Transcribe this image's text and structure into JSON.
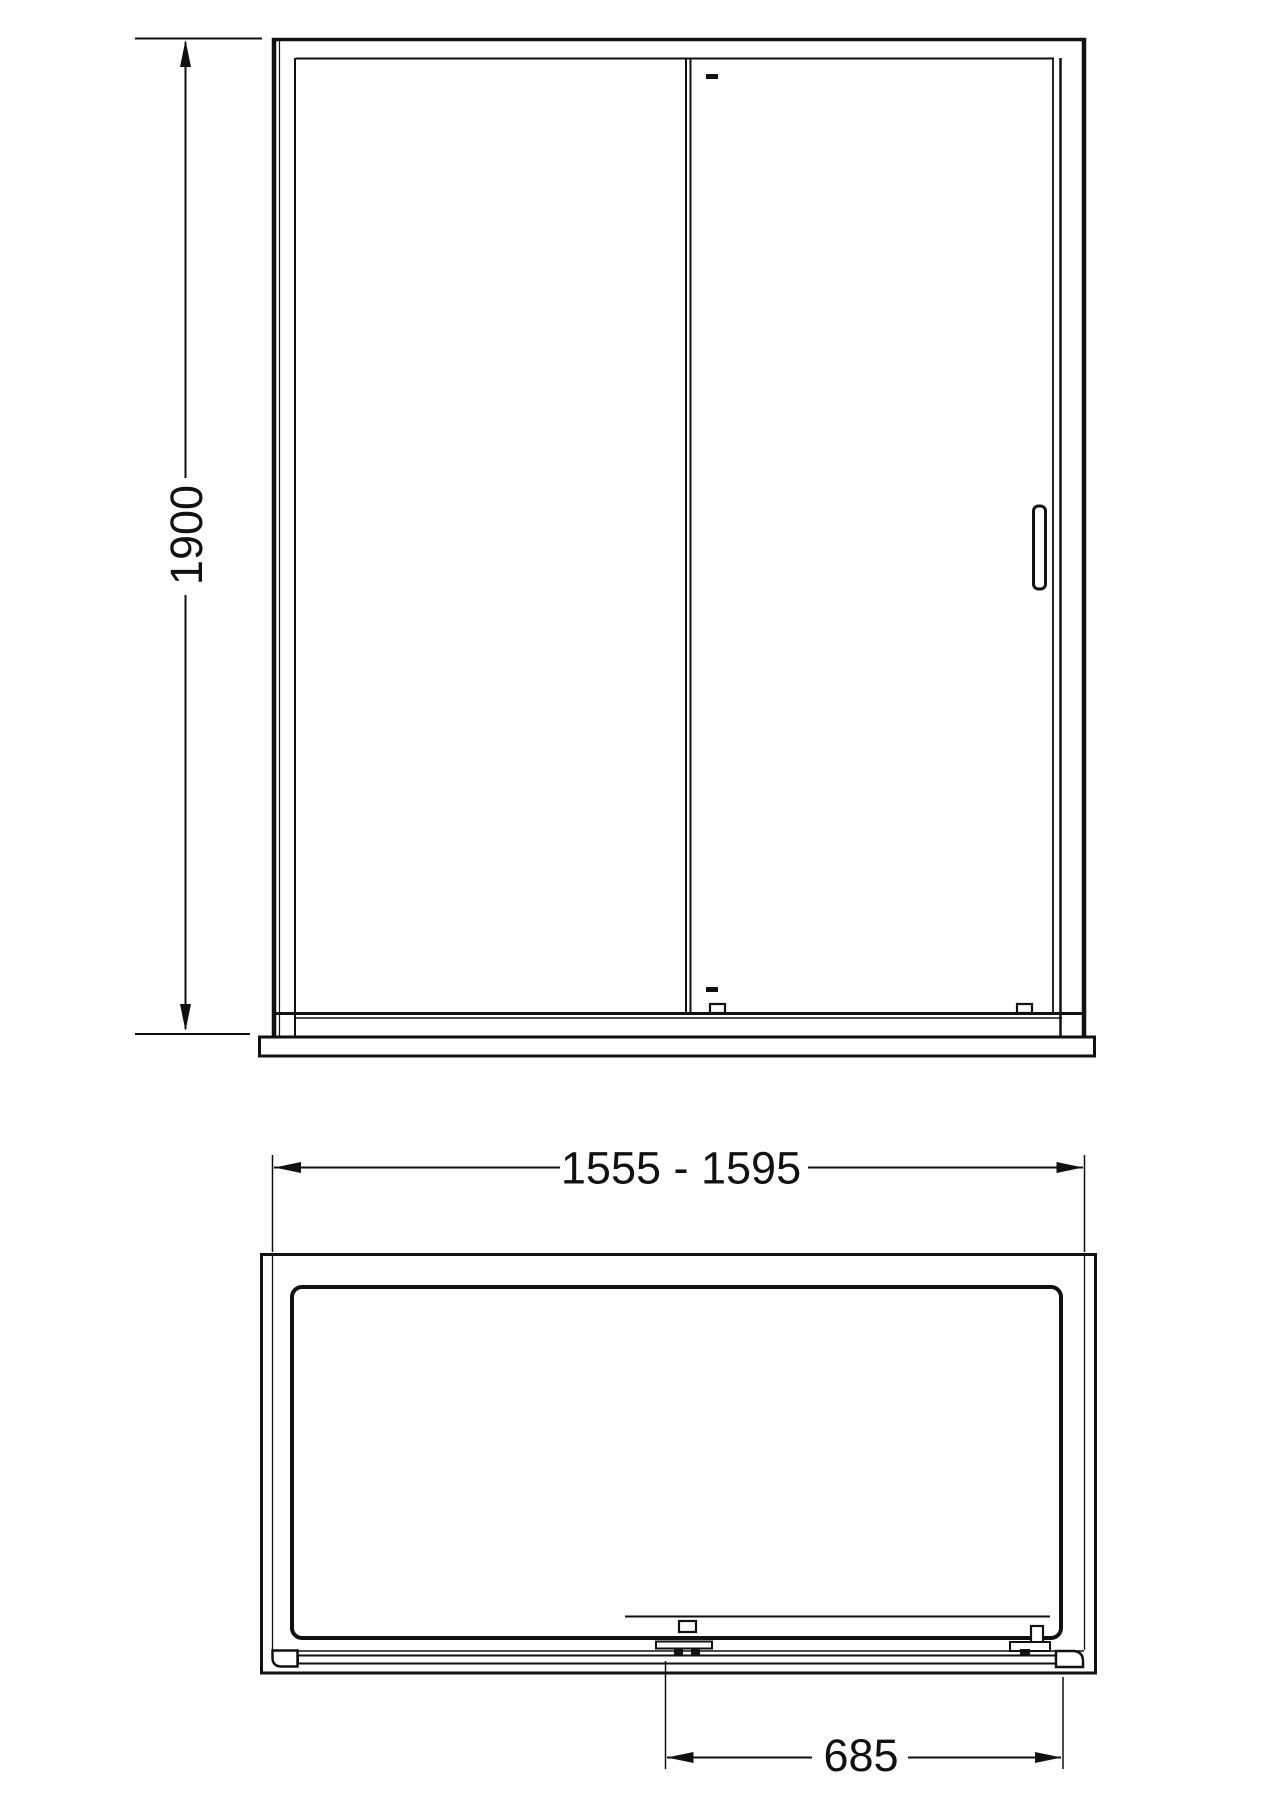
{
  "drawing": {
    "type": "technical-line-drawing",
    "subject": "sliding shower door enclosure with tray",
    "views": {
      "front_elevation": "front view with sliding door, handle and tray",
      "plan": "top view of tray with door track and rollers"
    },
    "dimensions": {
      "height": "1900",
      "width_range": "1555 - 1595",
      "opening": "685"
    },
    "colors": {
      "line": "#111111",
      "background": "#ffffff"
    }
  }
}
